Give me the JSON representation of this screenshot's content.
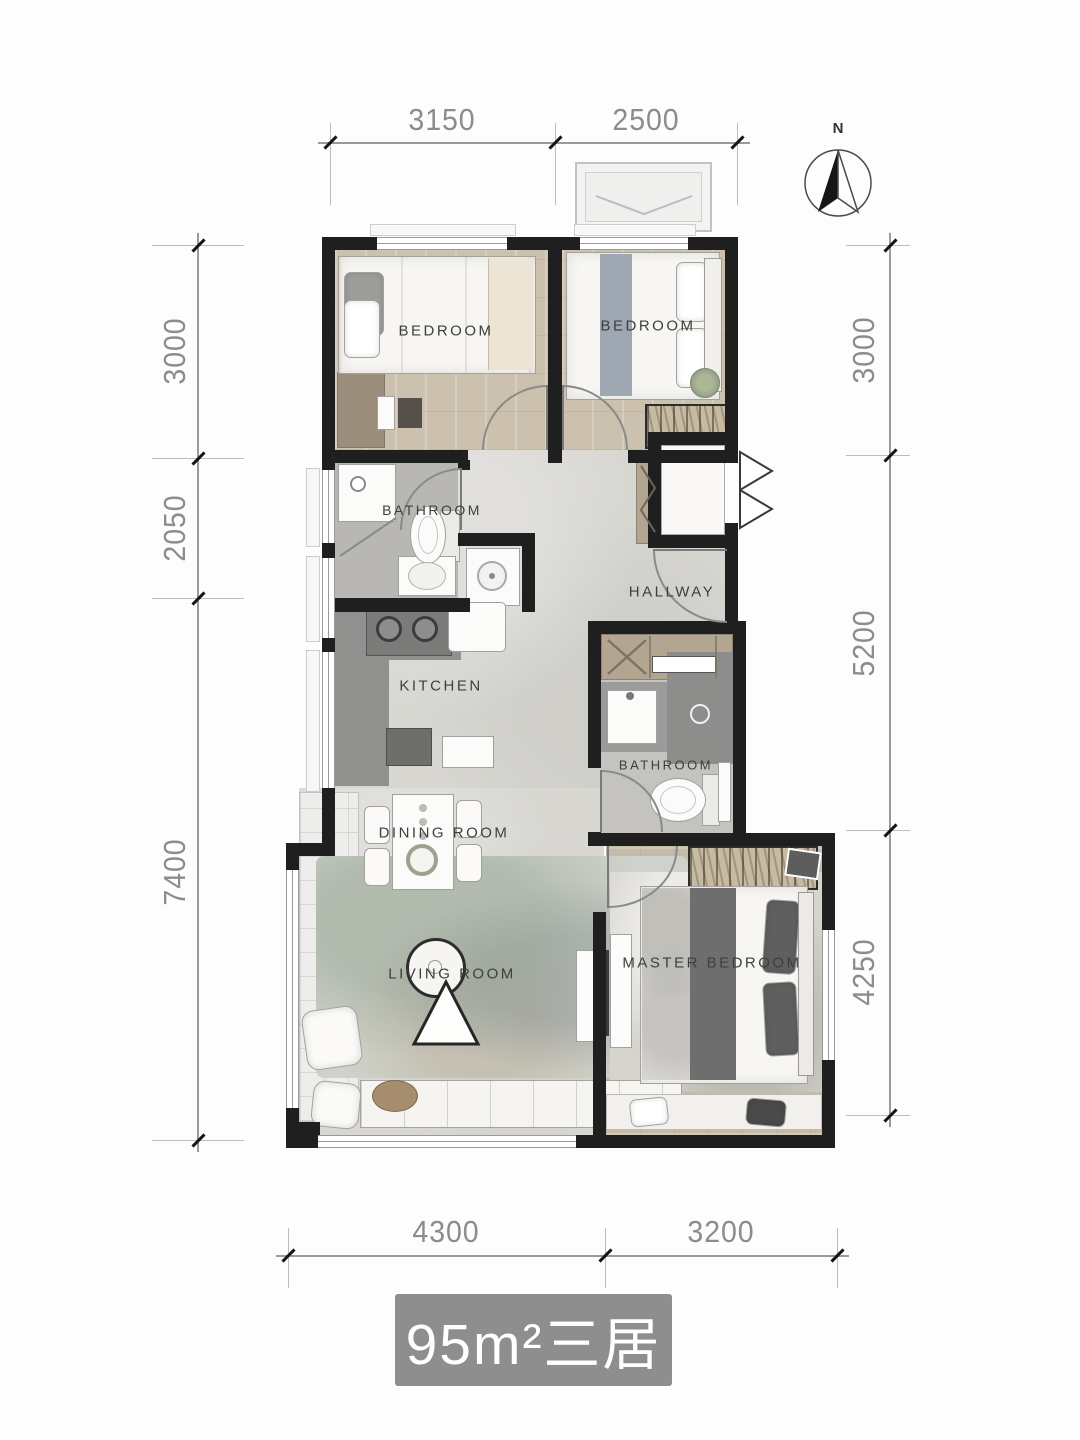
{
  "title_plate": {
    "text": "95m²三居"
  },
  "compass": {
    "label": "N"
  },
  "dimensions": {
    "top": [
      "3150",
      "2500"
    ],
    "left": [
      "3000",
      "2050",
      "7400"
    ],
    "right": [
      "3000",
      "5200",
      "4250"
    ],
    "bottom": [
      "4300",
      "3200"
    ]
  },
  "rooms": {
    "bedroom_left": "BEDROOM",
    "bedroom_right": "BEDROOM",
    "bathroom": "BATHROOM",
    "kitchen": "KITCHEN",
    "hallway": "HALLWAY",
    "bathroom_2": "BATHROOM",
    "dining": "DINING ROOM",
    "living": "LIVING ROOM",
    "master": "MASTER BEDROOM"
  },
  "colors": {
    "wall": "#1f1f1f",
    "wood_floor": "#ccc0ae",
    "tile_floor": "#d8d7d2",
    "plate_bg": "#8e8e8e",
    "dim_text": "#8c8c8c"
  }
}
